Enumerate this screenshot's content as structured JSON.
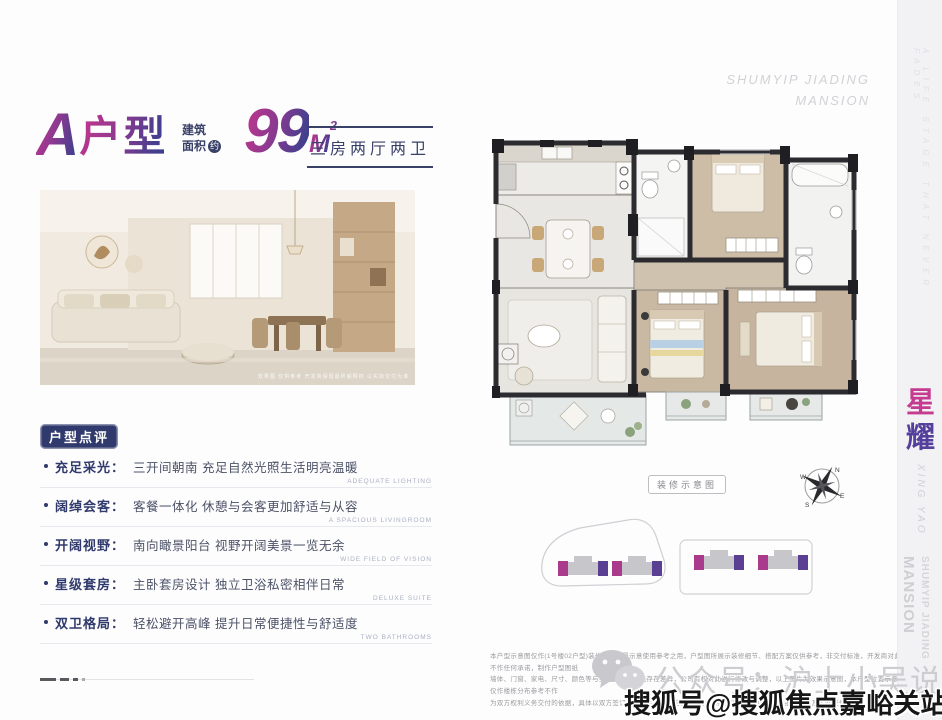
{
  "colors": {
    "gradient_from": "#b8368d",
    "gradient_to": "#3f3f8e",
    "navy": "#303a6c",
    "magenta_accent": "#a93a8c",
    "purple_accent": "#5a3f93",
    "watermark_gray": "#cdcdd1",
    "band_bg": "#f2f2f4"
  },
  "header": {
    "unit_letter": "A",
    "unit_suffix": "户型",
    "area_label_line1": "建筑",
    "area_label_line2": "面积",
    "area_approx_badge": "约",
    "area_value": "99",
    "area_unit": "M",
    "area_exponent": "2",
    "layout_summary": "三房两厅两卫",
    "brand_line1": "SHUMYIP JIADING",
    "brand_line2": "MANSION"
  },
  "photo": {
    "caption": "效果图 仅供参考 开发商保留最终解释权 以实际交付为准"
  },
  "review": {
    "badge": "户型点评",
    "items": [
      {
        "label": "充足采光：",
        "desc": "三开间朝南 充足自然光照生活明亮温暖",
        "en": "ADEQUATE LIGHTING"
      },
      {
        "label": "阔绰会客：",
        "desc": "客餐一体化 休憩与会客更加舒适与从容",
        "en": "A SPACIOUS LIVINGROOM"
      },
      {
        "label": "开阔视野：",
        "desc": "南向瞰景阳台 视野开阔美景一览无余",
        "en": "WIDE FIELD OF VISION"
      },
      {
        "label": "星级套房：",
        "desc": "主卧套房设计 独立卫浴私密相伴日常",
        "en": "DELUXE SUITE"
      },
      {
        "label": "双卫格局：",
        "desc": "轻松避开高峰 提升日常便捷性与舒适度",
        "en": "TWO BATHROOMS"
      }
    ]
  },
  "floorplan": {
    "tag": "装修示意图",
    "compass": {
      "n": "N",
      "e": "E",
      "s": "S",
      "w": "W"
    }
  },
  "sidebar": {
    "tagline_vertical": "A LIFE STAGE THAT NEVER FADES",
    "title_char_1": "星",
    "title_char_2": "耀",
    "title_en": "XING YAO",
    "watermark_line1": "MANSION",
    "watermark_line2": "SHUMYIP JIADING"
  },
  "footer": {
    "disclaimer_lines": [
      "本户型示意图仅作(1号楼02户型)装修风格场景示意使用参考之用，户型图所展示装修细节、搭配方案仅供参考，非交付标准，开发商对此不作任何承诺，制作户型图纸",
      "墙体、门窗、家电、尺寸、颜色等与实际交付物难免存在差异，公司有权对此进行修改与调整，以上图片为效果示意图，本户型位置示意仅作楼栋分布参考不作",
      "为双方权利义务交付的依据，具体以双方签订的《商品房买卖合同》及附件等协议为准 最终以政府批准文件及实际交付为准"
    ],
    "wechat_watermark": "公众号：沪上小吴说房",
    "sohu_watermark": "搜狐号@搜狐焦点嘉峪关站"
  }
}
